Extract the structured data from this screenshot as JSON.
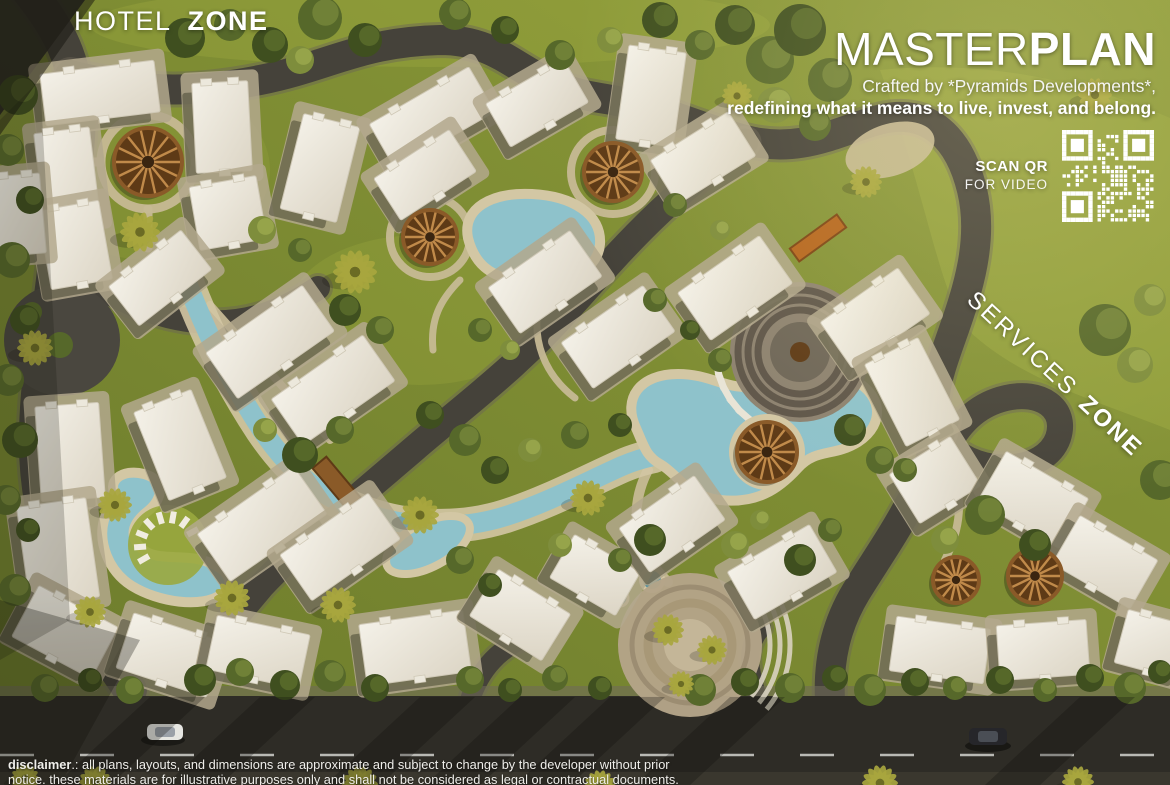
{
  "labels": {
    "hotel_zone": {
      "light": "HOTEL",
      "bold": "ZONE"
    },
    "masterplan": {
      "light": "MASTER",
      "bold": "PLAN"
    },
    "crafted": "Crafted by *Pyramids Developments*,",
    "tagline": "redefining what it means to live, invest, and belong.",
    "scan": {
      "line1": "SCAN QR",
      "line2": "FOR VIDEO"
    },
    "services": {
      "light": "SERVICES",
      "bold": "ZONE"
    },
    "disclaimer": {
      "word": "disclaimer",
      "rest1": ".: all plans, layouts, and dimensions are approximate and subject to change by the developer without prior",
      "line2": "notice. these materials are for illustrative purposes only and shall not be considered as legal or contractual documents."
    }
  },
  "colors": {
    "grass": "#7d8b33",
    "grass_light": "#9aa83f",
    "grass_dark": "#5c6b26",
    "road": "#45423a",
    "road_dark": "#2e2c26",
    "path": "#c6b995",
    "stone": "#b3a88d",
    "building": "#ece8dc",
    "building_shade": "#dcd5c5",
    "water": "#8ec2cb",
    "water_deep": "#5f939e",
    "sand": "#d3c7a4",
    "tree_dark": "#3f4f1f",
    "tree_mid": "#56682a",
    "tree_light": "#7e8d3c",
    "palm": "#a8a63e",
    "pergola": "#5e3a16",
    "pergola_spoke": "#c08a4a",
    "text": "#ffffff"
  }
}
